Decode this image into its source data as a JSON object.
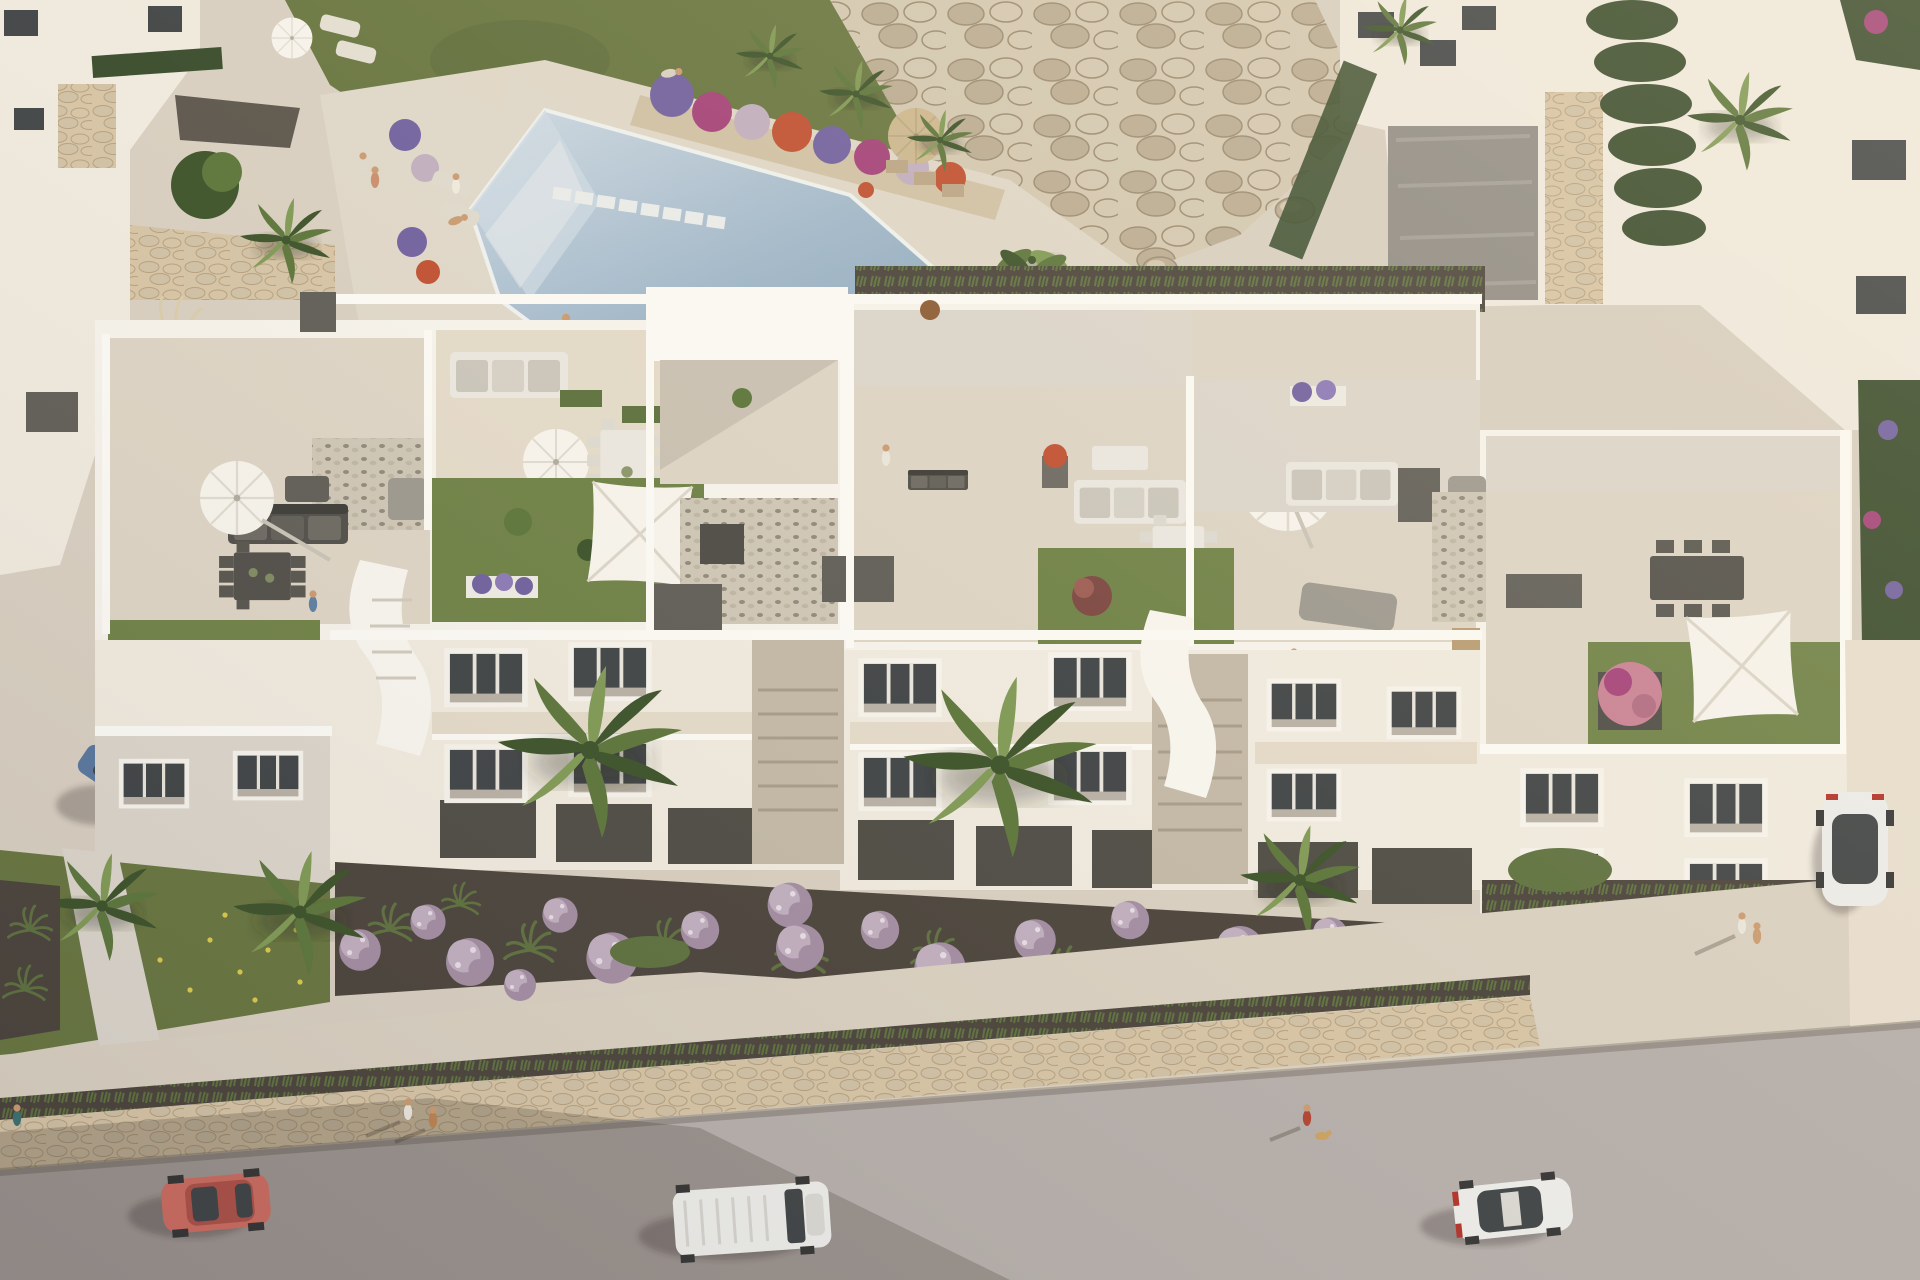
{
  "meta": {
    "scene_type": "aerial 3d architectural render",
    "description": "Bird's-eye view of a white Mediterranean apartment complex with penthouse roof terraces, a communal swimming pool with rock garden, front gardens with purple ball shrubs and fan palms, and a street with vehicles and pedestrians."
  },
  "palette": {
    "hardscape": "#d7cec0",
    "hardscape_light": "#e7ddcd",
    "hardscape_shade": "#c2b7a5",
    "deck": "#ded6c8",
    "pool_light": "#ccd8e2",
    "pool_mid": "#9fb6c9",
    "pool_deep": "#8ba6bc",
    "grass": "#66743e",
    "grass_roof": "#6d8045",
    "grass_dark": "#516035",
    "rock_light": "#d2c7b0",
    "rock_mid": "#b9ab92",
    "rock_dark": "#99896f",
    "palm_dark": "#3a5128",
    "palm_mid": "#5a7439",
    "palm_light": "#7e9853",
    "hedge": "#36492a",
    "mulch": "#49423a",
    "bush_purple": "#a18ba1",
    "bush_purple_light": "#bfadbe",
    "bush_green": "#5c6f3d",
    "flower_magenta": "#a23f77",
    "flower_red": "#bf4e30",
    "flower_purple": "#6f5f9e",
    "flower_pink": "#c87f93",
    "white_top": "#f5f2eb",
    "white_sun": "#efe9de",
    "white_shade": "#dad4ca",
    "white_deep": "#b7afa4",
    "tile": "#dcd3c4",
    "tile_warm": "#e3d9c8",
    "gravel": "#cdc5b5",
    "pebble": "#8f8778",
    "pebble_dark": "#5a544b",
    "box_gray": "#5e5c56",
    "furn_light": "#e9e6df",
    "furn_gray": "#9b978e",
    "furn_dark": "#4f4d48",
    "glass": "#3e4244",
    "street": "#b4ada9",
    "sidewalk": "#d8cfc0",
    "stonewall": "#d5c3a4",
    "stonewall_dark": "#b49f7f",
    "car_pink": "#c96a5e",
    "car_white": "#ebebe8",
    "car_blue": "#56759c",
    "wood": "#b89a72",
    "sand": "#cfc0a4",
    "skin": "#c9996f",
    "umb_white": "#f6f3ec",
    "umb_straw": "#cbb68d",
    "shadow": "rgba(58,50,40,0.30)"
  },
  "scene": {
    "labels": {
      "scene": "aerial view of apartment complex",
      "pool": "communal swimming pool",
      "rocks": "boulder rock garden",
      "building": "white apartment building with roof terraces",
      "garden": "front garden with purple shrubs and palms",
      "street": "street with vehicles and pedestrians",
      "lawn": "community lawn",
      "neighbors": "neighbouring villas"
    },
    "community_area": {
      "pool": {
        "swimmers": 1,
        "people_on_deck": 1,
        "stepping_stones": 8,
        "towel_basket": 1,
        "entry_steps": true
      },
      "umbrellas": {
        "white_round": 1,
        "straw": 1
      },
      "sun_loungers": 4,
      "flower_planter_colors": [
        "magenta",
        "red",
        "purple",
        "lavender"
      ]
    },
    "building": {
      "blocks": 3,
      "roof_terraces": 6,
      "terrace_features": [
        "cantilever parasol",
        "round parasols",
        "square shade sails",
        "outdoor sofas",
        "dining tables",
        "artificial lawns",
        "gravel patches",
        "utility boxes",
        "planters",
        "double sunbed",
        "lounger"
      ],
      "window_pairs": 16,
      "stairwells": 2,
      "balcony_bands": 3,
      "people_on_roofs": 6
    },
    "front_garden": {
      "purple_ball_shrubs": 17,
      "ornamental_grass_tufts": 12,
      "fan_palms": 7,
      "banana_plants": 3,
      "bougainvillea": 1,
      "left_lawn_flowers": "yellow"
    },
    "street": {
      "vehicles": [
        {
          "type": "coupe",
          "color_name": "salmon pink",
          "location": "street left"
        },
        {
          "type": "van",
          "color_name": "white",
          "location": "street centre"
        },
        {
          "type": "sedan",
          "color_name": "white",
          "location": "street right"
        },
        {
          "type": "hatchback",
          "color_name": "blue",
          "location": "left driveway"
        },
        {
          "type": "car",
          "color_name": "white with dark glass roof",
          "location": "parked side lane right"
        }
      ],
      "pedestrians": 9,
      "dog": 1
    }
  }
}
